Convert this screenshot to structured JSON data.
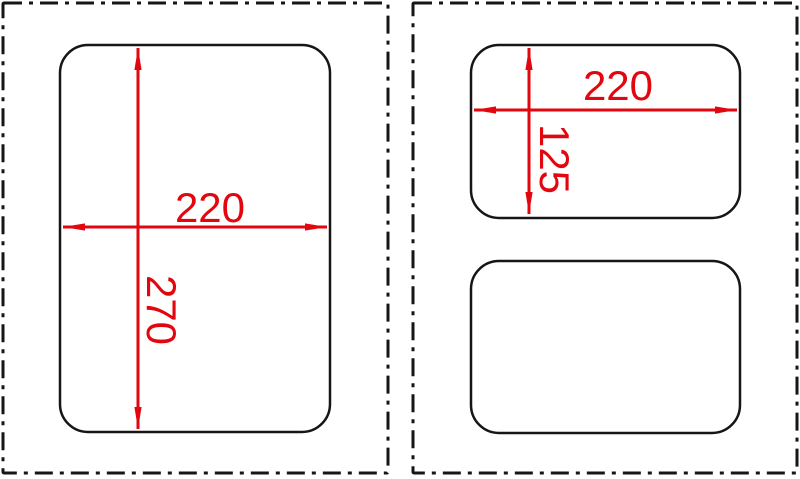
{
  "drawing": {
    "type": "cutout-dimension-diagram",
    "colors": {
      "dimension_red": "#e2060f",
      "outline_black": "#161616",
      "background": "#ffffff"
    },
    "left_panel": {
      "cutout": {
        "width_label": "220",
        "height_label": "270"
      }
    },
    "right_panel": {
      "top_cutout": {
        "width_label": "220",
        "height_label": "125"
      },
      "bottom_cutout": {
        "width_label": "",
        "height_label": ""
      }
    }
  }
}
